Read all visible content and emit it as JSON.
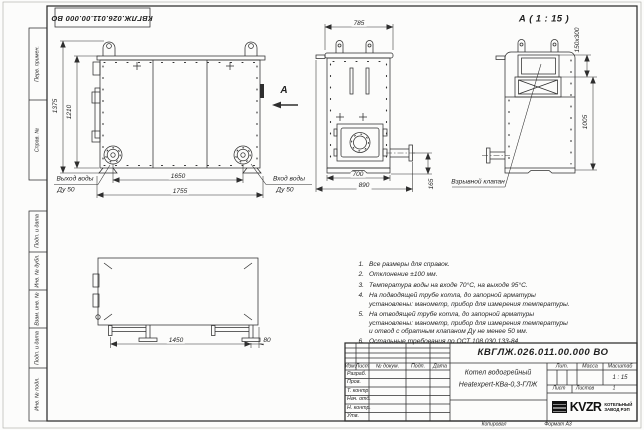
{
  "frame": {
    "top_stamp": "КВГЛЖ.026.011.00.000 ВО",
    "side_labels": [
      "Перв. примен.",
      "Справ. №",
      "Подп. и дата",
      "Инв. № дубл.",
      "Взам. инв. №",
      "Подп. и дата",
      "Инв. № подл."
    ],
    "copied": "Копировал",
    "format": "Формат А3"
  },
  "front_view": {
    "dim_height_total": "1375",
    "dim_height_body": "1210",
    "dim_width_flanges": "1650",
    "dim_width_total": "1755",
    "outlet_line1": "Выход воды",
    "outlet_line2": "Ду 50",
    "inlet_line1": "Вход воды",
    "inlet_line2": "Ду 50",
    "section_letter": "А"
  },
  "side_view": {
    "dim_top": "785",
    "dim_bottom_inner": "700",
    "dim_bottom_outer": "890",
    "dim_right": "165"
  },
  "detail_view": {
    "title": "А ( 1 : 15 )",
    "dim_hatch": "150х300",
    "dim_height": "1005",
    "callout": "Взрывной клапан"
  },
  "plan_view": {
    "dim_length": "1450",
    "dim_offset": "80"
  },
  "notes": [
    {
      "num": "1.",
      "text": "Все размеры для справок."
    },
    {
      "num": "2.",
      "text": "Отклонение ±100 мм."
    },
    {
      "num": "3.",
      "text": "Температура воды на входе 70°С, на выходе 95°С."
    },
    {
      "num": "4.",
      "text": "На подводящей трубе котла, до запорной арматуры установлены: манометр, прибор для измерения температуры."
    },
    {
      "num": "5.",
      "text": "На отводящей трубе котла, до запорной арматуры установлены: манометр, прибор для измерения температуры и отвод с обратным клапаном Ду не менее 50 мм."
    },
    {
      "num": "6.",
      "text": "Остальные требования по ОСТ 108.030.133-84."
    }
  ],
  "title_block": {
    "doc_number": "КВГЛЖ.026.011.00.000 ВО",
    "name_line1": "Котел водогрейный",
    "name_line2": "Heatexpert-КВа-0,3-ГЛЖ",
    "cols": {
      "izm": "Изм.",
      "list": "Лист",
      "doc": "№ докум.",
      "podp": "Подп.",
      "data": "Дата"
    },
    "staff_rows": [
      "Разраб.",
      "Пров.",
      "Т. контр.",
      "Нач. отд.",
      "Н. контр.",
      "Утв."
    ],
    "lit": "Лит.",
    "mass": "Масса",
    "scale_label": "Масштаб",
    "scale_value": "1 : 15",
    "sheet_label": "Лист",
    "sheets_label": "Листов",
    "sheets_value": "1",
    "logo": "KVZR",
    "company_line1": "КОТЕЛЬНЫЙ",
    "company_line2": "ЗАВОД РЭП"
  }
}
